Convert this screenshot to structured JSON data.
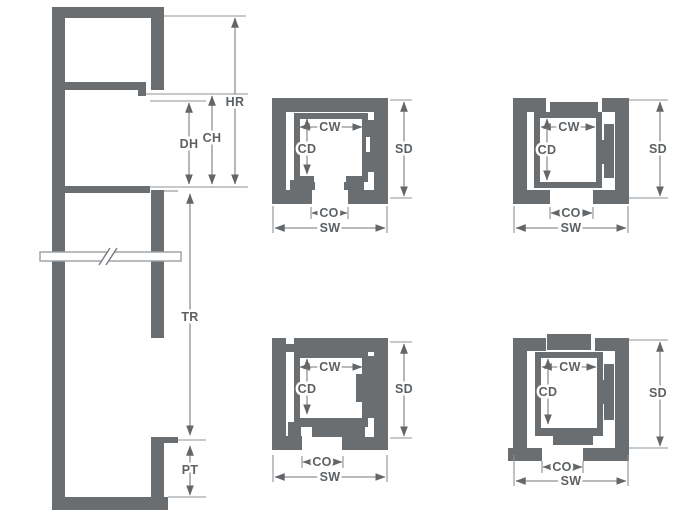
{
  "section": {
    "hr": "HR",
    "ch": "CH",
    "dh": "DH",
    "tr": "TR",
    "pt": "PT"
  },
  "plans": [
    {
      "position": "top-center",
      "labels": {
        "cw": "CW",
        "cd": "CD",
        "sd": "SD",
        "co": "CO",
        "sw": "SW"
      }
    },
    {
      "position": "top-right",
      "labels": {
        "cw": "CW",
        "cd": "CD",
        "sd": "SD",
        "co": "CO",
        "sw": "SW"
      }
    },
    {
      "position": "bottom-center",
      "labels": {
        "cw": "CW",
        "cd": "CD",
        "sd": "SD",
        "co": "CO",
        "sw": "SW"
      }
    },
    {
      "position": "bottom-right",
      "labels": {
        "cw": "CW",
        "cd": "CD",
        "sd": "SD",
        "co": "CO",
        "sw": "SW"
      }
    }
  ],
  "colors": {
    "wall": "#6a6e71",
    "dim_line": "#8d9193",
    "arrow": "#63676a",
    "text": "#5d6164",
    "background": "#ffffff"
  }
}
